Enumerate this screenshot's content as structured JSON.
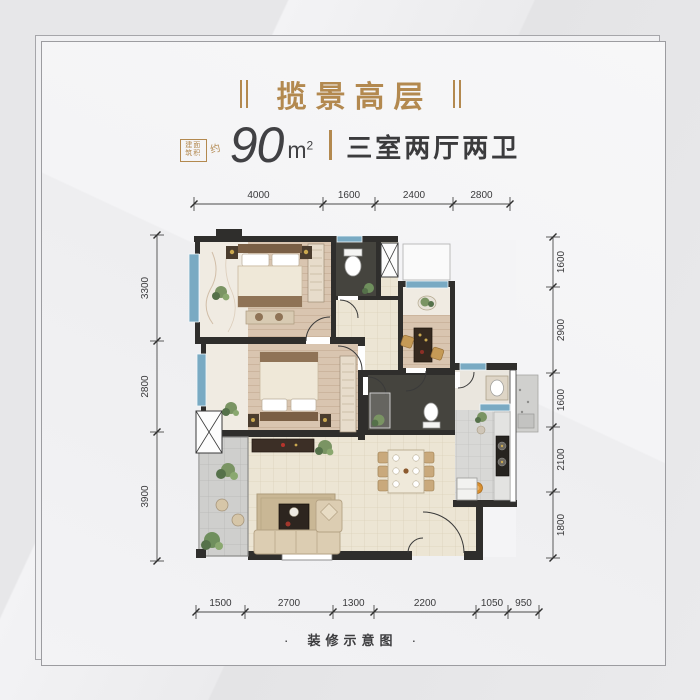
{
  "page": {
    "background_color": "#eaeaec",
    "card_background": "#f4f4f6",
    "accent_gold": "#b3894f"
  },
  "header": {
    "title": "揽景高层"
  },
  "area": {
    "prefix_rows": [
      "建面",
      "筑积"
    ],
    "prefix_approx": "约",
    "value": "90",
    "unit": "m",
    "unit_exponent": "2",
    "layout_label": "三室两厅两卫"
  },
  "footer": {
    "bullet": "·",
    "caption": "装修示意图"
  },
  "floorplan": {
    "dimensions": {
      "top": [
        "4000",
        "1600",
        "2400",
        "2800"
      ],
      "left": [
        "3300",
        "2800",
        "3900"
      ],
      "right": [
        "1600",
        "2900",
        "1600",
        "2100",
        "1800"
      ],
      "bottom": [
        "1500",
        "2700",
        "1300",
        "2200",
        "1050",
        "950"
      ]
    },
    "colors": {
      "wall": "#2f2e2c",
      "window_blue": "#79aac3",
      "wood_floor": "#d9c5b0",
      "beige_tile": "#ece5d4",
      "dark_bath_floor": "#45443e",
      "gray_kitchen_tile": "#d8d8d6",
      "balcony_tile": "#cfcfcd"
    }
  }
}
